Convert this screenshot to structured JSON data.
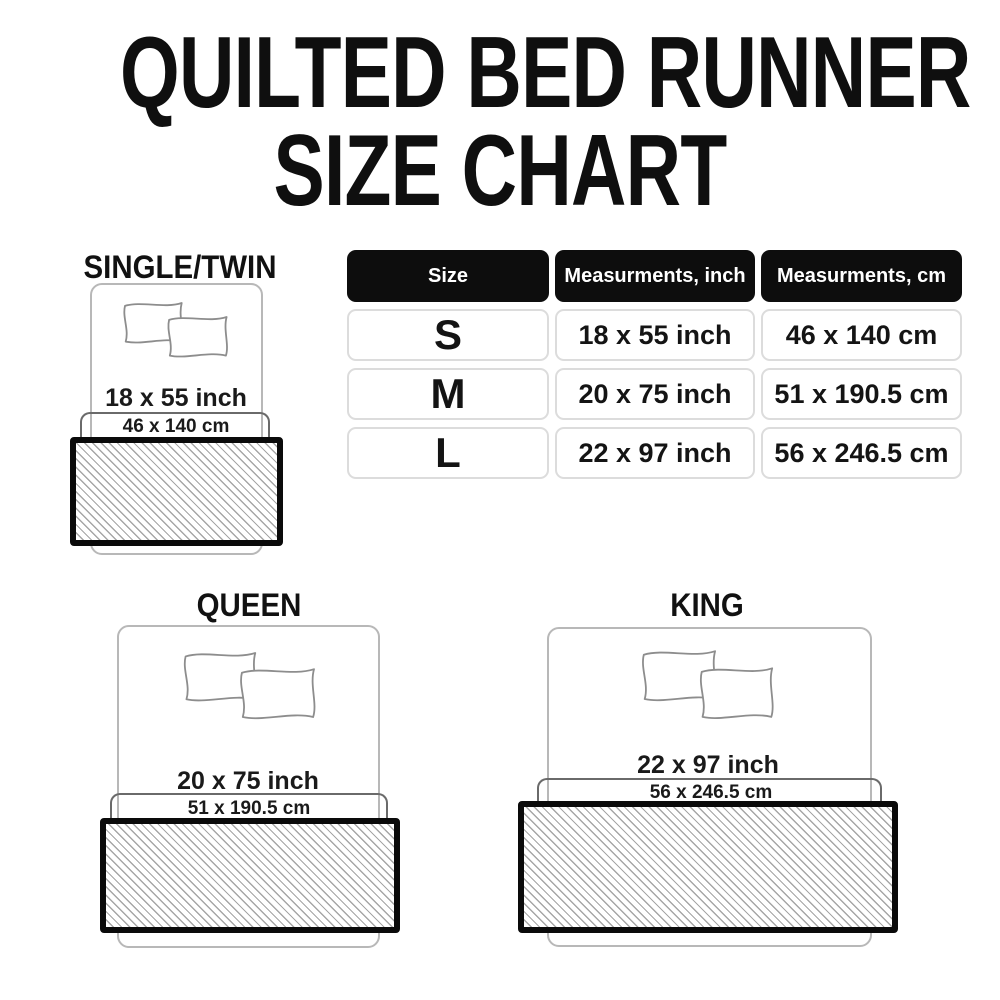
{
  "title": {
    "line1": "QUILTED BED RUNNER",
    "line2": "SIZE CHART"
  },
  "table": {
    "headers": [
      "Size",
      "Measurments, inch",
      "Measurments, cm"
    ],
    "rows": [
      {
        "size": "S",
        "inch": "18 x 55 inch",
        "cm": "46 x 140 cm"
      },
      {
        "size": "M",
        "inch": "20 x 75 inch",
        "cm": "51 x 190.5 cm"
      },
      {
        "size": "L",
        "inch": "22 x 97 inch",
        "cm": "56 x 246.5 cm"
      }
    ]
  },
  "sections": {
    "single": {
      "label": "SINGLE/TWIN",
      "inch": "18 x 55 inch",
      "cm": "46 x 140 cm"
    },
    "queen": {
      "label": "QUEEN",
      "inch": "20 x 75 inch",
      "cm": "51 x 190.5 cm"
    },
    "king": {
      "label": "KING",
      "inch": "22 x 97 inch",
      "cm": "56 x 246.5 cm"
    }
  },
  "colors": {
    "header_bg": "#0d0d0d",
    "header_text": "#ffffff",
    "cell_border": "#dcdcdc",
    "text": "#141414",
    "bed_outline": "#b8b8b8",
    "pillow_outline": "#8d8d8d",
    "bracket": "#6a6a6a",
    "runner_border": "#0a0a0a",
    "hatch_line": "#a6a6a6"
  }
}
